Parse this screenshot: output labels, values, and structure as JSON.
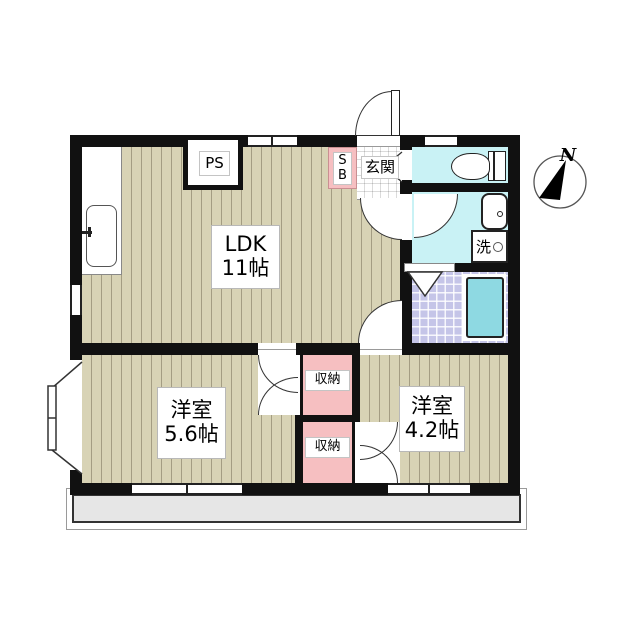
{
  "plan_type": "apartment-floor-plan",
  "labels": {
    "ldk": {
      "line1": "LDK",
      "line2": "11帖"
    },
    "bedroom_left": {
      "line1": "洋室",
      "line2": "5.6帖"
    },
    "bedroom_right": {
      "line1": "洋室",
      "line2": "4.2帖"
    },
    "closet_top": "収納",
    "closet_bottom": "収納",
    "entrance": "玄関",
    "shoebox_line1": "S",
    "shoebox_line2": "B",
    "pipe_space": "PS",
    "laundry": "洗",
    "compass_north": "N"
  },
  "colors": {
    "wall": "#111111",
    "flooring": "#d8d3b5",
    "flooring_stripe": "#a49d83",
    "closet_pink": "#f6bfc1",
    "wet_area_cyan": "#c9f2f5",
    "bath_tile": "#c5c5e8",
    "bathtub": "#8ed9e2",
    "balcony_gray": "#e6e6e6"
  }
}
